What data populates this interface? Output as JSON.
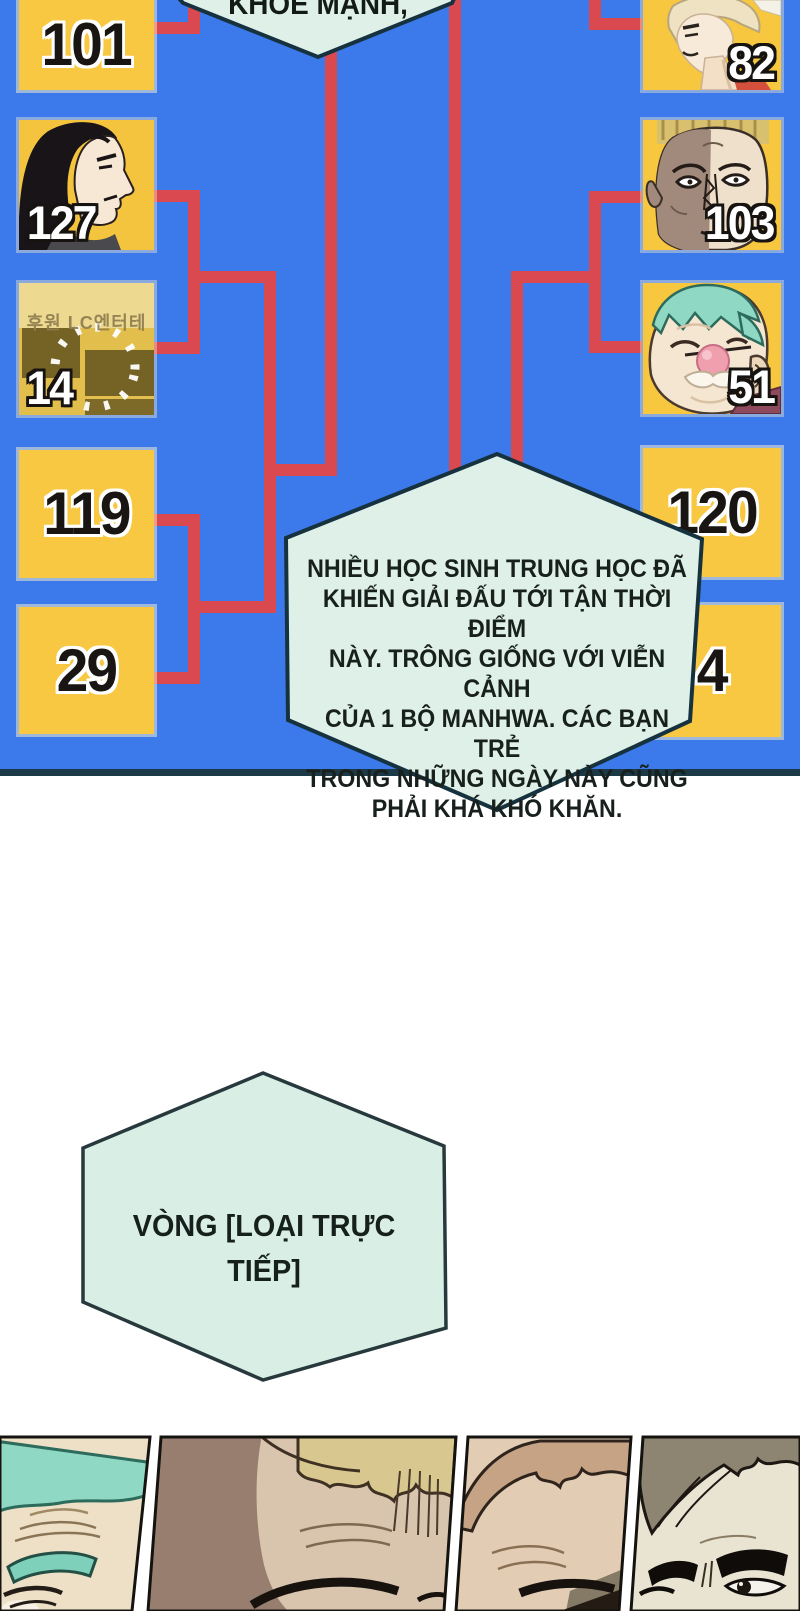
{
  "colors": {
    "panel_background": "#3c7aec",
    "bracket_line": "#d9494f",
    "box_yellow": "#f8c843",
    "bubble_fill": "#def0e7",
    "bubble_border": "#16323e",
    "panel_bottom_border": "#1c3947",
    "number_dark": "#181512",
    "number_light": "#ffffff"
  },
  "bracket": {
    "left": [
      {
        "label": "101",
        "type": "number"
      },
      {
        "label": "127",
        "type": "portrait",
        "portrait": "black-haired-man-profile"
      },
      {
        "label": "14",
        "type": "sponsor-card",
        "card_text": "후원 LC엔터테"
      },
      {
        "label": "119",
        "type": "number"
      },
      {
        "label": "29",
        "type": "number"
      }
    ],
    "right": [
      {
        "label": "82",
        "type": "portrait",
        "portrait": "blond-young-man-profile"
      },
      {
        "label": "103",
        "type": "portrait",
        "portrait": "scarred-shadowed-man"
      },
      {
        "label": "51",
        "type": "portrait",
        "portrait": "old-man-teal-bandana"
      },
      {
        "label": "120",
        "type": "number"
      },
      {
        "label": "4",
        "type": "number"
      }
    ]
  },
  "bubbles": {
    "top": {
      "text": "KHỎE MẠNH,"
    },
    "middle": {
      "lines": [
        "NHIỀU HỌC SINH TRUNG HỌC ĐÃ",
        "KHIẾN GIẢI ĐẤU TỚI TẬN THỜI ĐIỂM",
        "NÀY. TRÔNG GIỐNG VỚI VIỄN CẢNH",
        "CỦA 1 BỘ MANHWA. CÁC BẠN TRẺ",
        "TRONG NHỮNG NGÀY NÀY CŨNG",
        "PHẢI KHÁ KHÓ KHĂN."
      ]
    },
    "round": {
      "lines": [
        "VÒNG [LOẠI TRỰC",
        "TIẾP]"
      ]
    }
  },
  "comic_strip": {
    "panels": [
      {
        "name": "old-man-teal-bandana-closeup"
      },
      {
        "name": "blond-man-shadowed-forehead"
      },
      {
        "name": "brown-haired-man-forehead"
      },
      {
        "name": "dark-haired-man-glaring"
      }
    ]
  }
}
